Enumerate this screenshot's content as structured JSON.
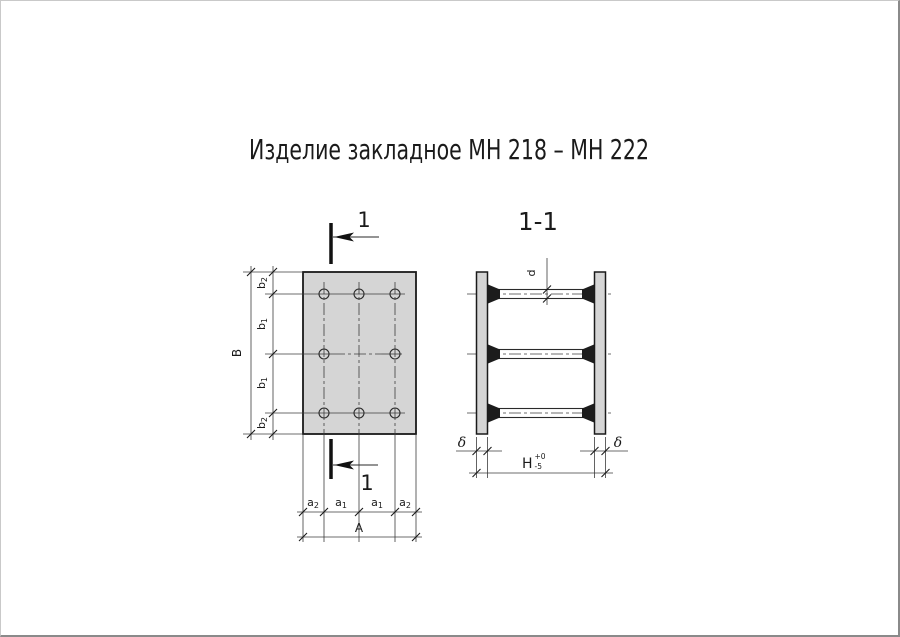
{
  "title": "Изделие закладное МН 218 – МН 222",
  "plan_view": {
    "section_cut_label": "1",
    "anchor_count": 8,
    "dims": {
      "B": "B",
      "b1_base": "b",
      "b1_sub": "1",
      "b2_base": "b",
      "b2_sub": "2",
      "A": "A",
      "a1_base": "a",
      "a1_sub": "1",
      "a2_base": "a",
      "a2_sub": "2"
    }
  },
  "section_view": {
    "label": "1-1",
    "rod_count": 3,
    "dims": {
      "d": "d",
      "delta": "δ",
      "H_base": "H",
      "H_tol_upper": "+0",
      "H_tol_lower": "-5"
    }
  },
  "colors": {
    "plate_fill": "#d5d5d5",
    "rod_fill": "#d0d0d0",
    "weld_fill": "#1c1c1c",
    "line_dark": "#1a1a1a",
    "line_thin": "#3c3c3c"
  }
}
